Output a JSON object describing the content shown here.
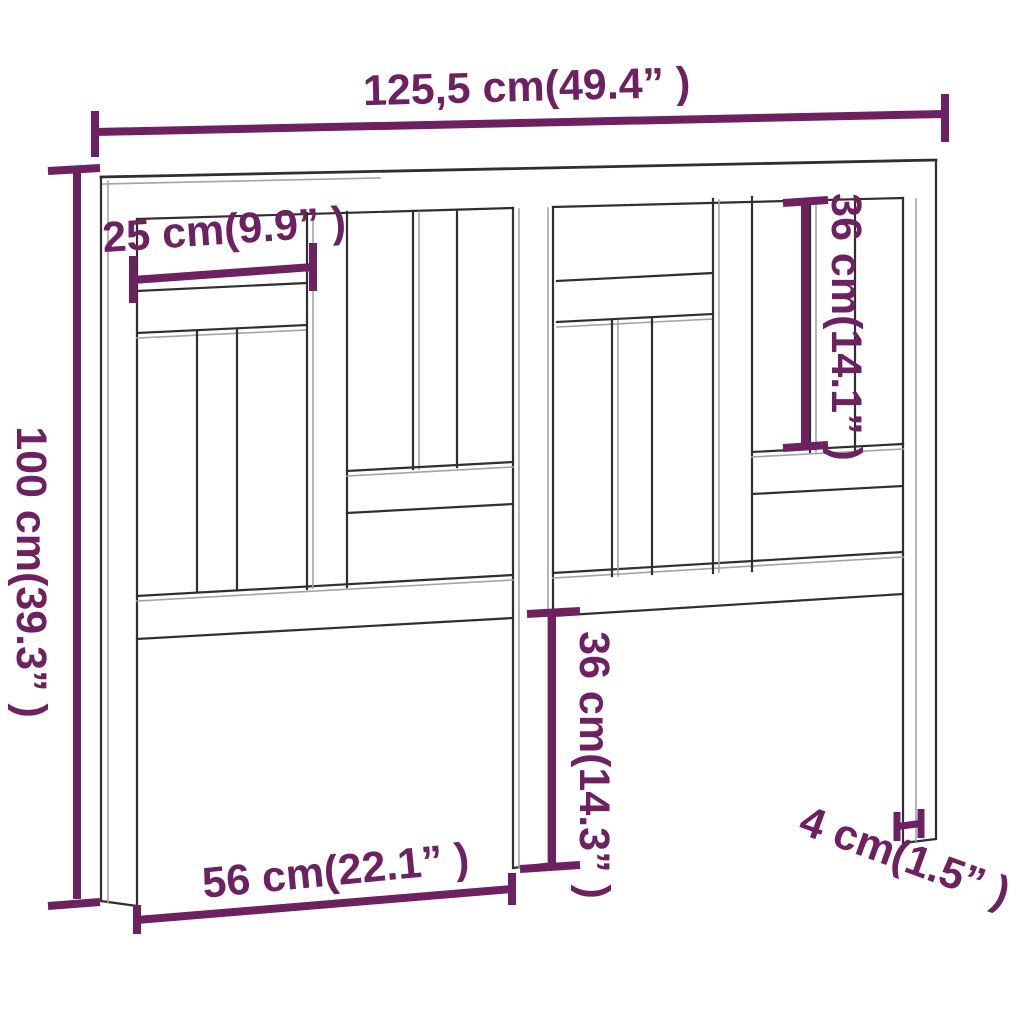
{
  "dimensions": {
    "overall_width": {
      "label": "125,5 cm(49.4” )"
    },
    "overall_height": {
      "label": "100 cm(39.3” )"
    },
    "top_board_length": {
      "label": "25 cm(9.9” )"
    },
    "upper_slat_height": {
      "label": "36 cm(14.1” )"
    },
    "leg_height": {
      "label": "36 cm(14.3” )"
    },
    "leg_span": {
      "label": "56 cm(22.1” )"
    },
    "leg_width": {
      "label": "4 cm(1.5” )"
    }
  },
  "colors": {
    "dimension_accent": "#6e2160",
    "drawing_line": "#2f2f2f",
    "background": "#ffffff"
  }
}
